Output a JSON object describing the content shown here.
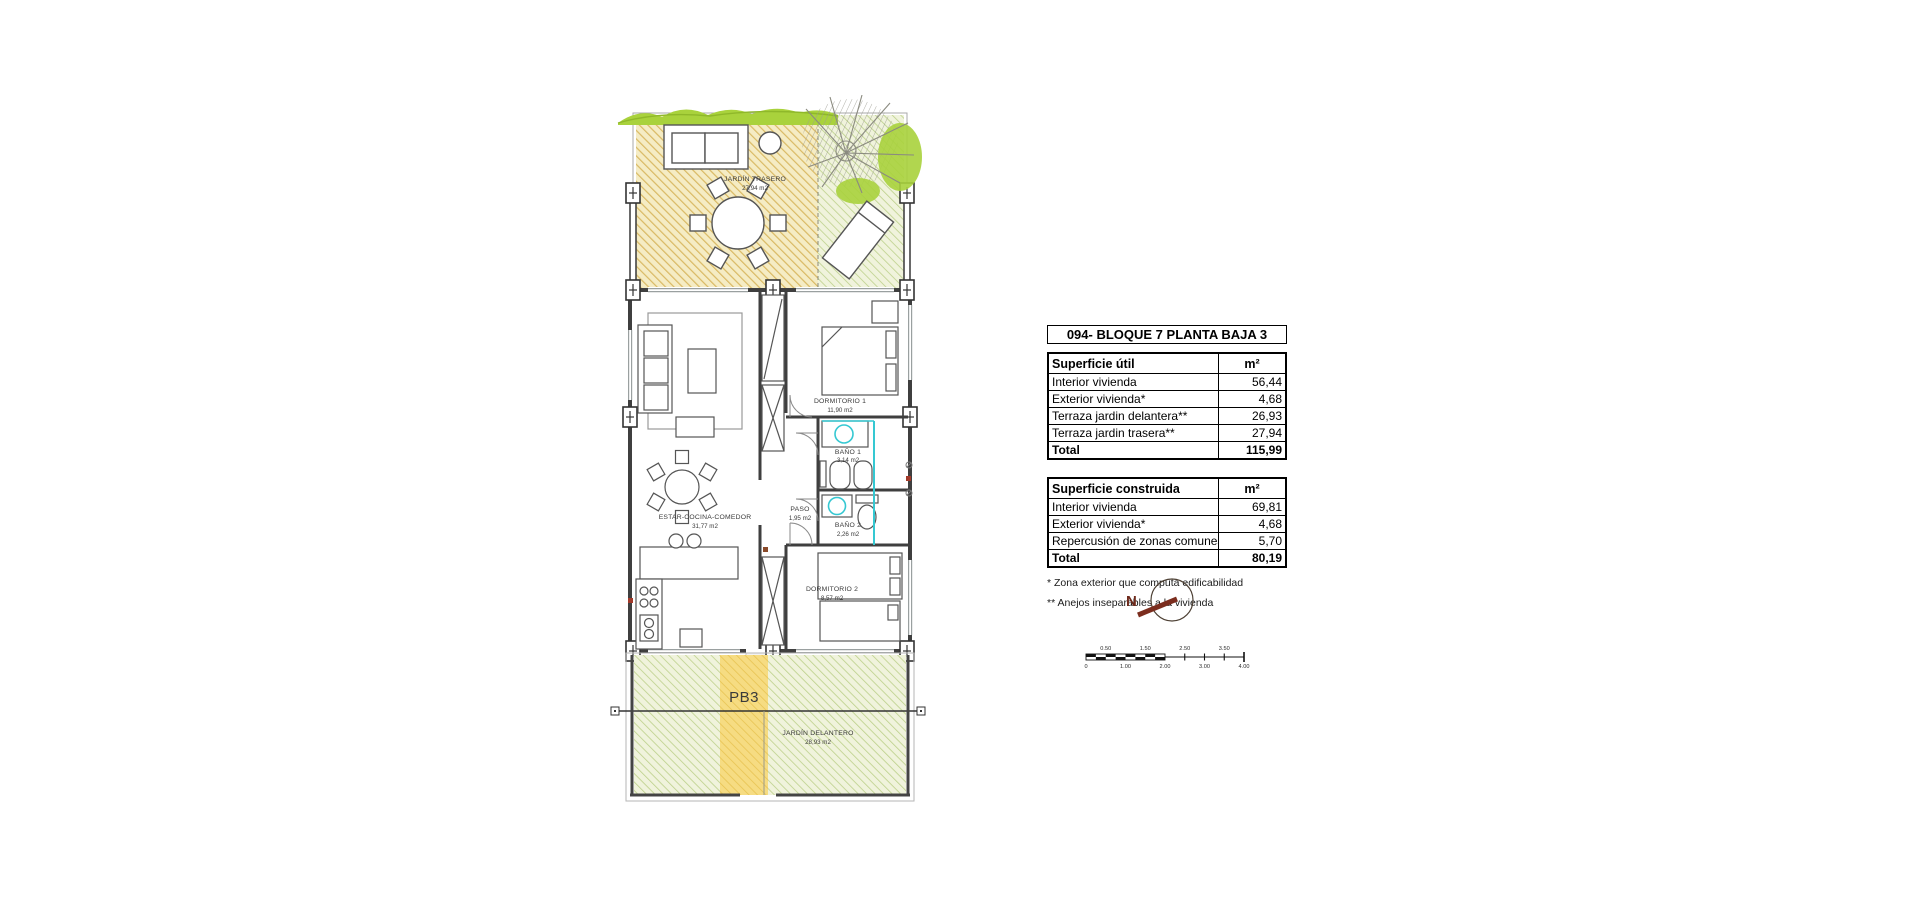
{
  "plan": {
    "unit_label": "PB3",
    "rooms": {
      "jardin_trasero": {
        "name": "JARDÍN TRASERO",
        "area": "27,94 m2"
      },
      "dormitorio1": {
        "name": "DORMITORIO 1",
        "area": "11,90 m2"
      },
      "bano1": {
        "name": "BAÑO 1",
        "area": "3,14 m2"
      },
      "bano2": {
        "name": "BAÑO 2",
        "area": "2,26 m2"
      },
      "paso": {
        "name": "PASO",
        "area": "1,95 m2"
      },
      "estar": {
        "name": "ESTAR-COCINA-COMEDOR",
        "area": "31,77 m2"
      },
      "dormitorio2": {
        "name": "DORMITORIO 2",
        "area": "8,57 m2"
      },
      "jardin_delantero": {
        "name": "JARDÍN DELANTERO",
        "area": "28,93 m2"
      }
    },
    "compass": {
      "north": "N"
    },
    "scalebar": {
      "top": [
        "0.50",
        "1.50",
        "2.50",
        "3.50"
      ],
      "bottom": [
        "0",
        "1.00",
        "2.00",
        "3.00",
        "4.00"
      ]
    }
  },
  "panel": {
    "title": "094- BLOQUE 7 PLANTA BAJA 3",
    "table_util": {
      "header": {
        "label": "Superficie útil",
        "unit": "m²"
      },
      "rows": [
        {
          "label": "Interior vivienda",
          "value": "56,44"
        },
        {
          "label": "Exterior vivienda*",
          "value": "4,68"
        },
        {
          "label": "Terraza jardin delantera**",
          "value": "26,93"
        },
        {
          "label": "Terraza jardin trasera**",
          "value": "27,94"
        }
      ],
      "total": {
        "label": "Total",
        "value": "115,99"
      }
    },
    "table_construida": {
      "header": {
        "label": "Superficie construida",
        "unit": "m²"
      },
      "rows": [
        {
          "label": "Interior vivienda",
          "value": "69,81"
        },
        {
          "label": "Exterior vivienda*",
          "value": "4,68"
        },
        {
          "label": "Repercusión de zonas comunes",
          "value": "5,70"
        }
      ],
      "total": {
        "label": "Total",
        "value": "80,19"
      }
    },
    "footnotes": [
      "* Zona exterior que computa edificabilidad",
      "** Anejos inseparables a la vivienda"
    ]
  },
  "colors": {
    "garden_tan": "#f5ecc4",
    "garden_tan_line": "#d9b963",
    "garden_green": "#f0f3dc",
    "garden_green_line": "#bcd08a",
    "vegetation": "#a9d23c",
    "path_yellow": "#f6dc82",
    "plumbing_cyan": "#35c8d2",
    "compass_red": "#6e2a1c"
  }
}
